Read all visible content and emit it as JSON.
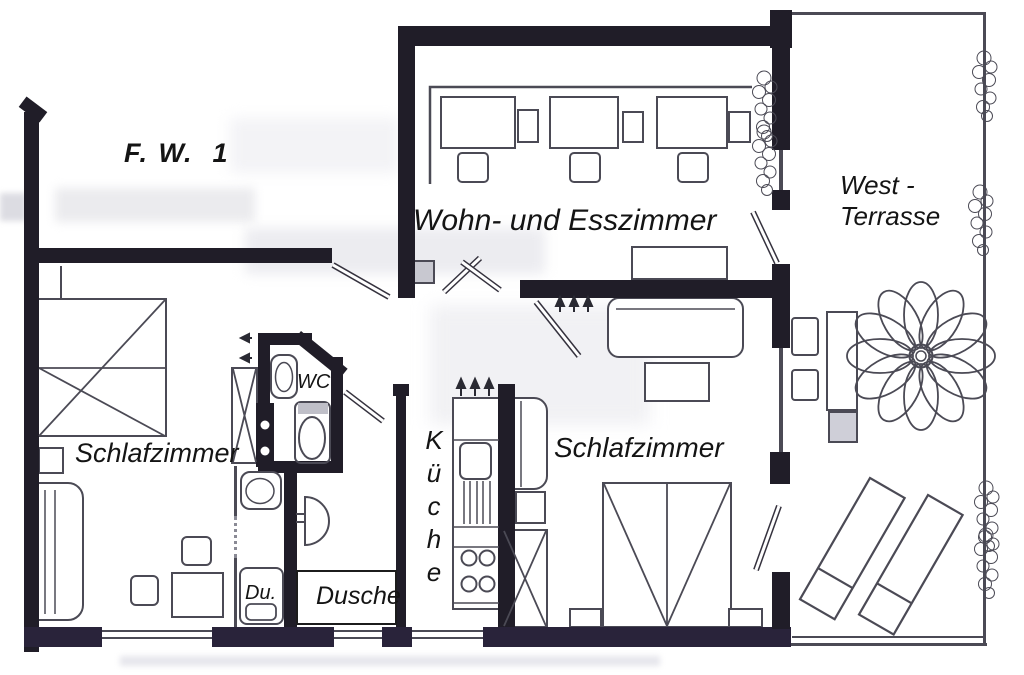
{
  "colors": {
    "paper": "#ffffff",
    "ink": "#17151d",
    "wall": "#201d28",
    "line": "#4b4a55",
    "text": "#141414"
  },
  "plan": {
    "unit_label": "F. W.  1",
    "rooms": {
      "living": {
        "name": "Wohn- und Esszimmer"
      },
      "terrace": {
        "name_line1": "West -",
        "name_line2": "Terrasse"
      },
      "bedroom_left": {
        "name": "Schlafzimmer"
      },
      "bedroom_right": {
        "name": "Schlafzimmer"
      },
      "kitchen": {
        "name": "Küche",
        "letters": [
          "K",
          "ü",
          "c",
          "h",
          "e"
        ]
      },
      "wc": {
        "name": "WC"
      },
      "shower_tray": {
        "name": "Du."
      },
      "shower": {
        "name": "Dusche"
      }
    }
  }
}
